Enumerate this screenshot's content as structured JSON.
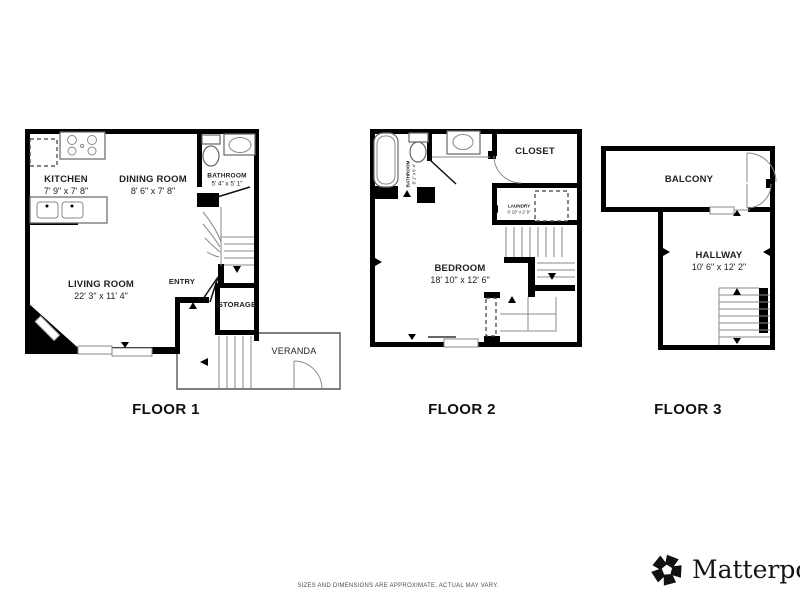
{
  "floors": [
    {
      "label": "FLOOR 1",
      "rooms": {
        "kitchen": {
          "name": "KITCHEN",
          "dims": "7' 9\" x 7' 8\""
        },
        "dining_room": {
          "name": "DINING ROOM",
          "dims": "8' 6\" x 7' 8\""
        },
        "bathroom": {
          "name": "BATHROOM",
          "dims": "5' 4\" x 5' 1\""
        },
        "living_room": {
          "name": "LIVING ROOM",
          "dims": "22' 3\" x 11' 4\""
        },
        "entry": {
          "name": "ENTRY"
        },
        "storage": {
          "name": "STORAGE"
        },
        "veranda": {
          "name": "VERANDA"
        }
      }
    },
    {
      "label": "FLOOR 2",
      "rooms": {
        "bathroom": {
          "name": "BATHROOM",
          "dims": "8' 1\" x 6' 4\""
        },
        "closet": {
          "name": "CLOSET"
        },
        "laundry": {
          "name": "LAUNDRY",
          "dims": "6' 10\" x 2' 9\""
        },
        "bedroom": {
          "name": "BEDROOM",
          "dims": "18' 10\" x 12' 6\""
        }
      }
    },
    {
      "label": "FLOOR 3",
      "rooms": {
        "balcony": {
          "name": "BALCONY"
        },
        "hallway": {
          "name": "HALLWAY",
          "dims": "10' 6\" x 12' 2\""
        }
      }
    }
  ],
  "footer": {
    "disclaimer": "SIZES AND DIMENSIONS ARE APPROXIMATE, ACTUAL MAY VARY.",
    "brand": "Matterport",
    "brand_mark": "®"
  },
  "colors": {
    "wall": "#000000",
    "thin_line": "#8a8a8a",
    "label_text": "#222222"
  }
}
